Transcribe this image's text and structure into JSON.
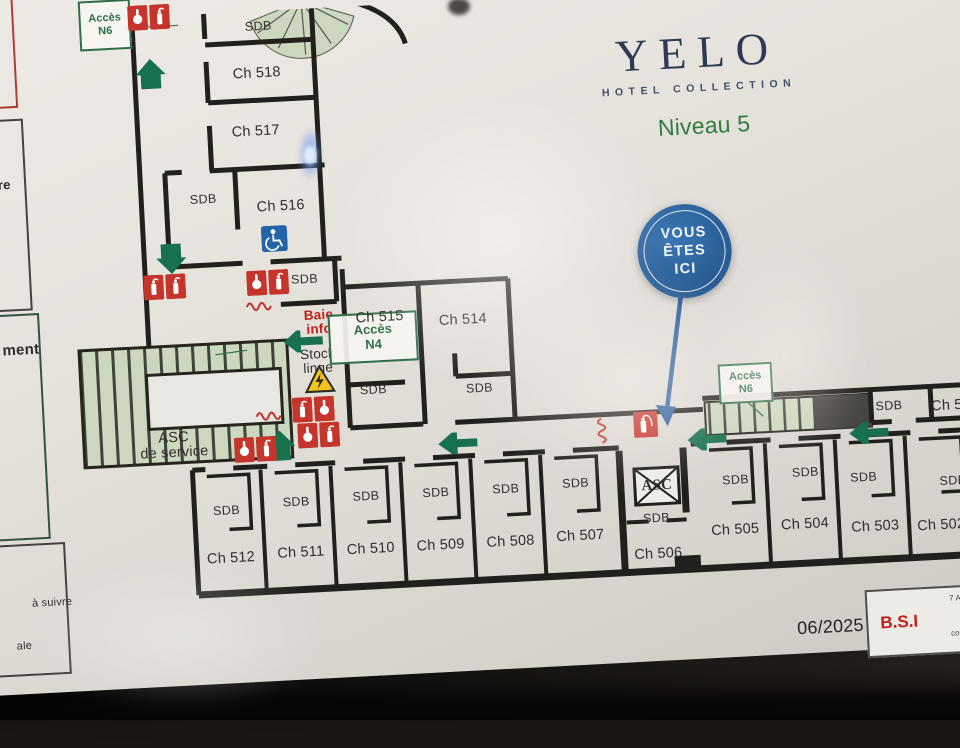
{
  "brand": {
    "name": "YELO",
    "sub": "HOTEL COLLECTION",
    "level": "Niveau 5"
  },
  "you_are_here": {
    "line1": "VOUS",
    "line2": "ÊTES",
    "line3": "ICI"
  },
  "labels": {
    "sdb": "SDB",
    "asc": "ASC",
    "asc_service_l1": "ASC",
    "asc_service_l2": "de service",
    "baie_l1": "Baie",
    "baie_l2": "info",
    "stock_l1": "Stock",
    "stock_l2": "linge",
    "acces": "Accès",
    "n4": "N4",
    "n6": "N6",
    "ch_partial": "Ch 50"
  },
  "rooms": {
    "ch502": "Ch 502",
    "ch503": "Ch 503",
    "ch504": "Ch 504",
    "ch505": "Ch 505",
    "ch506": "Ch 506",
    "ch507": "Ch 507",
    "ch508": "Ch 508",
    "ch509": "Ch 509",
    "ch510": "Ch 510",
    "ch511": "Ch 511",
    "ch512": "Ch 512",
    "ch514": "Ch 514",
    "ch515": "Ch 515",
    "ch516": "Ch 516",
    "ch517": "Ch 517",
    "ch518": "Ch 518"
  },
  "legend_partials": {
    "p1": "re",
    "p2": "ment",
    "p3": "à suivre",
    "p4": "ale"
  },
  "footer": {
    "date": "06/2025",
    "bsi": "B.S.I",
    "contact_l1": "7 Av. M",
    "contact_l2": "06",
    "contact_l3": "06.S",
    "contact_l4": "contact"
  },
  "colors": {
    "accent_blue": "#2a6096",
    "accent_green": "#1e7a50",
    "accent_red": "#c1201c",
    "wall": "#22201c",
    "stair_fill": "#cbd7bf"
  }
}
